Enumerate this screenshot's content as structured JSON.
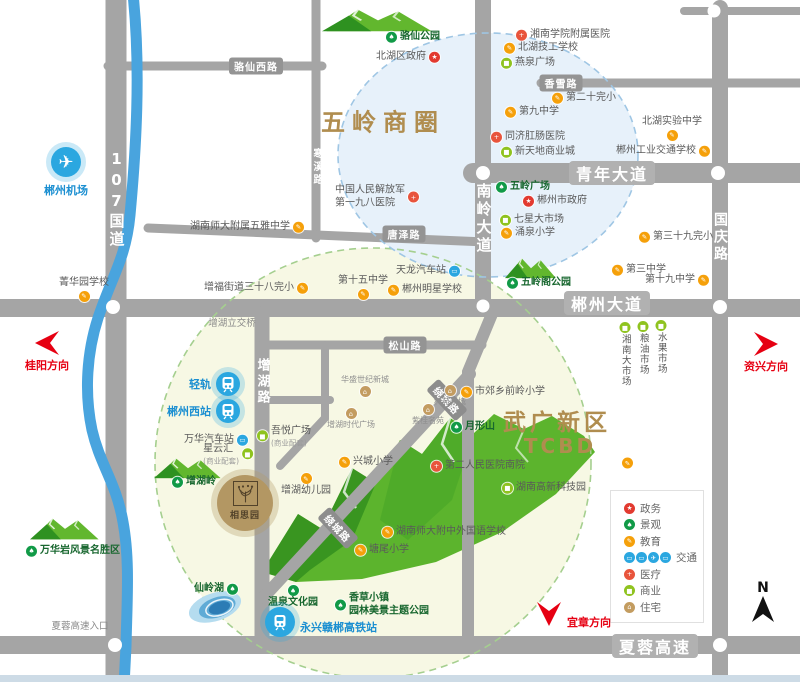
{
  "zones": {
    "wuling_label": "五岭商圈",
    "wuguang_line1": "武广新区",
    "wuguang_line2": "TCBD",
    "accent_color": "#b08d4f",
    "wuling_fill": "#e7f1fa",
    "wuguang_fill": "#f7f8e4"
  },
  "project": {
    "name": "相思园"
  },
  "compass": {
    "label": "N"
  },
  "categories": {
    "gov": {
      "label": "政务",
      "color": "#e23a30",
      "glyph": "★"
    },
    "landscape": {
      "label": "景观",
      "color": "#119a47",
      "glyph": "♠"
    },
    "edu": {
      "label": "教育",
      "color": "#f5a00a",
      "glyph": "✎"
    },
    "transport": {
      "label": "交通",
      "color": "#2ba7e0",
      "glyph": "▭"
    },
    "medical": {
      "label": "医疗",
      "color": "#e8543c",
      "glyph": "+"
    },
    "commercial": {
      "label": "商业",
      "color": "#8fc31f",
      "glyph": "■"
    },
    "residential": {
      "label": "住宅",
      "color": "#c39c60",
      "glyph": "⌂"
    }
  },
  "legend_order": [
    "gov",
    "landscape",
    "edu",
    "transport",
    "medical",
    "commercial",
    "residential"
  ],
  "legend_transport_glyphs": [
    "▭",
    "▭",
    "✈",
    "▭"
  ],
  "road_labels": [
    {
      "name": "骆仙西路",
      "x": 256,
      "y": 66,
      "type": "tag"
    },
    {
      "name": "香雪路",
      "x": 561,
      "y": 83,
      "type": "tag"
    },
    {
      "name": "唐泽路",
      "x": 404,
      "y": 234,
      "type": "tag"
    },
    {
      "name": "松山路",
      "x": 405,
      "y": 345,
      "type": "tag"
    },
    {
      "name": "青年大道",
      "x": 612,
      "y": 173,
      "type": "avenue"
    },
    {
      "name": "郴州大道",
      "x": 607,
      "y": 303,
      "type": "avenue"
    },
    {
      "name": "夏蓉高速",
      "x": 655,
      "y": 646,
      "type": "avenue"
    },
    {
      "name": "107国道",
      "x": 116,
      "y": 150,
      "type": "vertical",
      "size": 15
    },
    {
      "name": "寒溪路",
      "x": 316,
      "y": 148,
      "type": "vertical",
      "size": 10
    },
    {
      "name": "南岭大道",
      "x": 483,
      "y": 183,
      "type": "vertical",
      "size": 15
    },
    {
      "name": "国庆路",
      "x": 720,
      "y": 212,
      "type": "vertical",
      "size": 14
    },
    {
      "name": "增湖路",
      "x": 262,
      "y": 358,
      "type": "vertical",
      "size": 13
    },
    {
      "name": "绕城路",
      "x": 447,
      "y": 400,
      "type": "rotated",
      "rot": 47
    },
    {
      "name": "绕城路",
      "x": 338,
      "y": 528,
      "type": "rotated",
      "rot": 47
    }
  ],
  "markers": [
    {
      "label": "骆仙公园",
      "category": "landscape",
      "x": 392,
      "y": 37,
      "side": "left",
      "green": true
    },
    {
      "label": "北湖区政府",
      "category": "gov",
      "x": 433,
      "y": 57,
      "side": "right"
    },
    {
      "label": "湘南学院附属医院",
      "category": "medical",
      "x": 522,
      "y": 35,
      "side": "left"
    },
    {
      "label": "北湖技工学校",
      "category": "edu",
      "x": 510,
      "y": 48,
      "side": "left"
    },
    {
      "label": "燕泉广场",
      "category": "commercial",
      "x": 507,
      "y": 63,
      "side": "left"
    },
    {
      "label": "第二十完小",
      "category": "edu",
      "x": 558,
      "y": 98,
      "side": "left"
    },
    {
      "label": "第九中学",
      "category": "edu",
      "x": 511,
      "y": 112,
      "side": "left"
    },
    {
      "label": "同济肛肠医院",
      "category": "medical",
      "x": 497,
      "y": 137,
      "side": "left"
    },
    {
      "label": "新天地商业城",
      "category": "commercial",
      "x": 507,
      "y": 152,
      "side": "left"
    },
    {
      "label": "北湖实验中学",
      "category": "edu",
      "x": 672,
      "y": 116,
      "side": "icon-bottom"
    },
    {
      "label": "郴州工业交通学校",
      "category": "edu",
      "x": 703,
      "y": 151,
      "side": "right"
    },
    {
      "label": "中国人民解放军",
      "sub": "第一九八医院",
      "sub_big": true,
      "category": "medical",
      "x": 412,
      "y": 197,
      "side": "right"
    },
    {
      "label": "五岭广场",
      "category": "landscape",
      "x": 502,
      "y": 187,
      "side": "left",
      "green": true
    },
    {
      "label": "郴州市政府",
      "category": "gov",
      "x": 529,
      "y": 201,
      "side": "left"
    },
    {
      "label": "七星大市场",
      "category": "commercial",
      "x": 506,
      "y": 220,
      "side": "left"
    },
    {
      "label": "涌泉小学",
      "category": "edu",
      "x": 507,
      "y": 233,
      "side": "left"
    },
    {
      "label": "第三十九完小",
      "category": "edu",
      "x": 645,
      "y": 237,
      "side": "left"
    },
    {
      "label": "第三中学",
      "category": "edu",
      "x": 618,
      "y": 270,
      "side": "left"
    },
    {
      "label": "第十九中学",
      "category": "edu",
      "x": 702,
      "y": 280,
      "side": "right"
    },
    {
      "label": "五岭阁公园",
      "category": "landscape",
      "x": 513,
      "y": 283,
      "side": "left",
      "green": true
    },
    {
      "label": "湖南师大附属五雅中学",
      "category": "edu",
      "x": 297,
      "y": 227,
      "side": "right"
    },
    {
      "label": "增福街道三十八完小",
      "category": "edu",
      "x": 301,
      "y": 288,
      "side": "right"
    },
    {
      "label": "第十五中学",
      "category": "edu",
      "x": 363,
      "y": 275,
      "side": "icon-bottom"
    },
    {
      "label": "郴州明星学校",
      "category": "edu",
      "x": 394,
      "y": 290,
      "side": "left"
    },
    {
      "label": "天龙汽车站",
      "category": "transport",
      "x": 453,
      "y": 271,
      "side": "right"
    },
    {
      "label": "菁华园学校",
      "category": "edu",
      "x": 84,
      "y": 277,
      "side": "icon-bottom"
    },
    {
      "label": "万华汽车站",
      "category": "transport",
      "x": 241,
      "y": 440,
      "side": "right"
    },
    {
      "label": "星云汇",
      "sub": "(商业配套)",
      "category": "commercial",
      "x": 246,
      "y": 454,
      "side": "right"
    },
    {
      "label": "吾悦广场",
      "sub": "(商业配套)",
      "category": "commercial",
      "x": 263,
      "y": 436,
      "side": "left"
    },
    {
      "label": "华盛世纪新城",
      "category": "residential",
      "x": 365,
      "y": 375,
      "side": "icon-bottom",
      "small": true
    },
    {
      "label": "增湖时代广场",
      "category": "residential",
      "x": 351,
      "y": 408,
      "side": "icon-top",
      "small": true
    },
    {
      "label": "科苑新城",
      "category": "residential",
      "x": 450,
      "y": 385,
      "side": "icon-top",
      "small": true
    },
    {
      "label": "紫桂名苑",
      "category": "residential",
      "x": 428,
      "y": 404,
      "side": "icon-top",
      "small": true
    },
    {
      "label": "月形山",
      "category": "landscape",
      "x": 457,
      "y": 427,
      "side": "left",
      "green": true
    },
    {
      "label": "市郊乡前岭小学",
      "category": "edu",
      "x": 467,
      "y": 392,
      "side": "left"
    },
    {
      "label": "兴城小学",
      "category": "edu",
      "x": 345,
      "y": 462,
      "side": "left"
    },
    {
      "label": "增湖幼儿园",
      "category": "edu",
      "x": 306,
      "y": 473,
      "side": "icon-top"
    },
    {
      "label": "第二人民医院南院",
      "category": "medical",
      "x": 437,
      "y": 466,
      "side": "left"
    },
    {
      "label": "湖南高新科技园",
      "category": "commercial",
      "x": 508,
      "y": 488,
      "side": "left"
    },
    {
      "label": "",
      "category": "edu",
      "x": 628,
      "y": 463,
      "side": "left"
    },
    {
      "label": "湘南大市场",
      "category": "commercial",
      "x": 625,
      "y": 322,
      "side": "vertical"
    },
    {
      "label": "粮油市场",
      "category": "commercial",
      "x": 643,
      "y": 321,
      "side": "vertical"
    },
    {
      "label": "水果市场",
      "category": "commercial",
      "x": 661,
      "y": 320,
      "side": "vertical"
    },
    {
      "label": "增湖岭",
      "category": "landscape",
      "x": 178,
      "y": 482,
      "side": "left",
      "green": true
    },
    {
      "label": "万华岩风景名胜区",
      "category": "landscape",
      "x": 32,
      "y": 551,
      "side": "left",
      "green": true
    },
    {
      "label": "仙岭湖",
      "category": "landscape",
      "x": 231,
      "y": 589,
      "side": "right",
      "green": true
    },
    {
      "label": "温泉文化园",
      "category": "landscape",
      "x": 293,
      "y": 585,
      "side": "icon-top",
      "green": true
    },
    {
      "label": "香草小镇",
      "sub": "园林美景主题公园",
      "sub_big": true,
      "category": "landscape",
      "x": 341,
      "y": 605,
      "side": "left",
      "green": true
    },
    {
      "label": "塘尾小学",
      "category": "edu",
      "x": 361,
      "y": 550,
      "side": "left"
    },
    {
      "label": "湖南师大附中外国语学校",
      "category": "edu",
      "x": 388,
      "y": 532,
      "side": "left"
    }
  ],
  "hubs": [
    {
      "label": "郴州机场",
      "glyph": "plane",
      "x": 66,
      "y": 162,
      "r": 15,
      "side": "below"
    },
    {
      "label": "轻轨",
      "glyph": "train",
      "x": 228,
      "y": 384,
      "r": 12,
      "side": "left"
    },
    {
      "label": "郴州西站",
      "glyph": "train",
      "x": 228,
      "y": 411,
      "r": 12,
      "side": "left"
    },
    {
      "label": "永兴赣郴高铁站",
      "glyph": "train",
      "x": 280,
      "y": 622,
      "r": 15,
      "side": "right"
    }
  ],
  "notes": [
    {
      "text": "增湖立交桥",
      "x": 232,
      "y": 322
    },
    {
      "text": "夏蓉高速入口",
      "x": 80,
      "y": 625
    }
  ],
  "directions": [
    {
      "label": "桂阳方向",
      "dir": "left",
      "x": 47,
      "y": 343
    },
    {
      "label": "资兴方向",
      "dir": "right",
      "x": 766,
      "y": 344
    },
    {
      "label": "宜章方向",
      "dir": "down",
      "x": 549,
      "y": 616
    }
  ]
}
